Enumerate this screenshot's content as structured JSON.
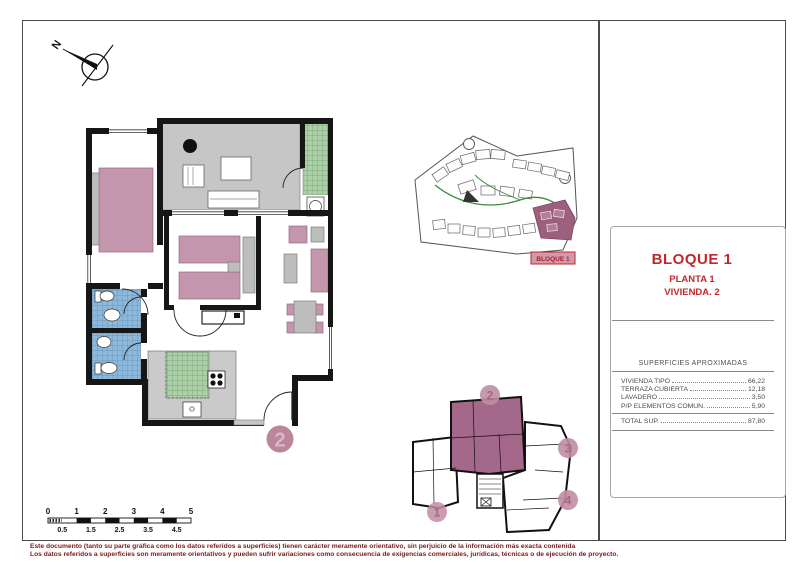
{
  "title_block": {
    "block_name": "BLOQUE 1",
    "floor_name": "PLANTA 1",
    "unit_name": "VIVIENDA. 2"
  },
  "areas_table": {
    "header": "SUPERFICIES APROXIMADAS",
    "rows": [
      {
        "label": "VIVIENDA TIPO",
        "value": "66,22"
      },
      {
        "label": "TERRAZA CUBIERTA",
        "value": "12,18"
      },
      {
        "label": "LAVADERO",
        "value": "3,50"
      },
      {
        "label": "P/P ELEMENTOS COMUN.",
        "value": "5,90"
      }
    ],
    "total_row": {
      "label": "TOTAL SUP.",
      "value": "87,80"
    }
  },
  "site_plan": {
    "highlight_label": "BLOQUE 1"
  },
  "key_plan": {
    "highlighted_unit": "2",
    "unit_badges": [
      "1",
      "2",
      "3",
      "4"
    ]
  },
  "floor_plan": {
    "unit_badge": "2"
  },
  "compass": {
    "north_label": "N"
  },
  "scale_bar": {
    "major_labels": [
      "0",
      "1",
      "2",
      "3",
      "4",
      "5"
    ],
    "minor_labels": [
      "0.5",
      "1.5",
      "2.5",
      "3.5",
      "4.5"
    ]
  },
  "disclaimer": {
    "line1": "Este documento (tanto su parte gráfica como los datos referidos a superficies) tienen carácter meramente orientativo, sin perjuicio de la información más exacta contenida",
    "line2": "Los datos referidos a superficies son meramente orientativos y pueden sufrir variaciones como consecuencia de exigencias comerciales, jurídicas, técnicas o de ejecución de proyecto."
  },
  "colors": {
    "accent_red": "#c1272d",
    "furniture_mauve": "#c496ae",
    "highlight_mauve": "#a4698a",
    "badge_pink": "#c18ca2",
    "tile_green": "#abcfa6",
    "tile_blue": "#8db8da",
    "terrace_gray": "#c6c6c6",
    "disclaimer_red": "#7a1a1a"
  }
}
